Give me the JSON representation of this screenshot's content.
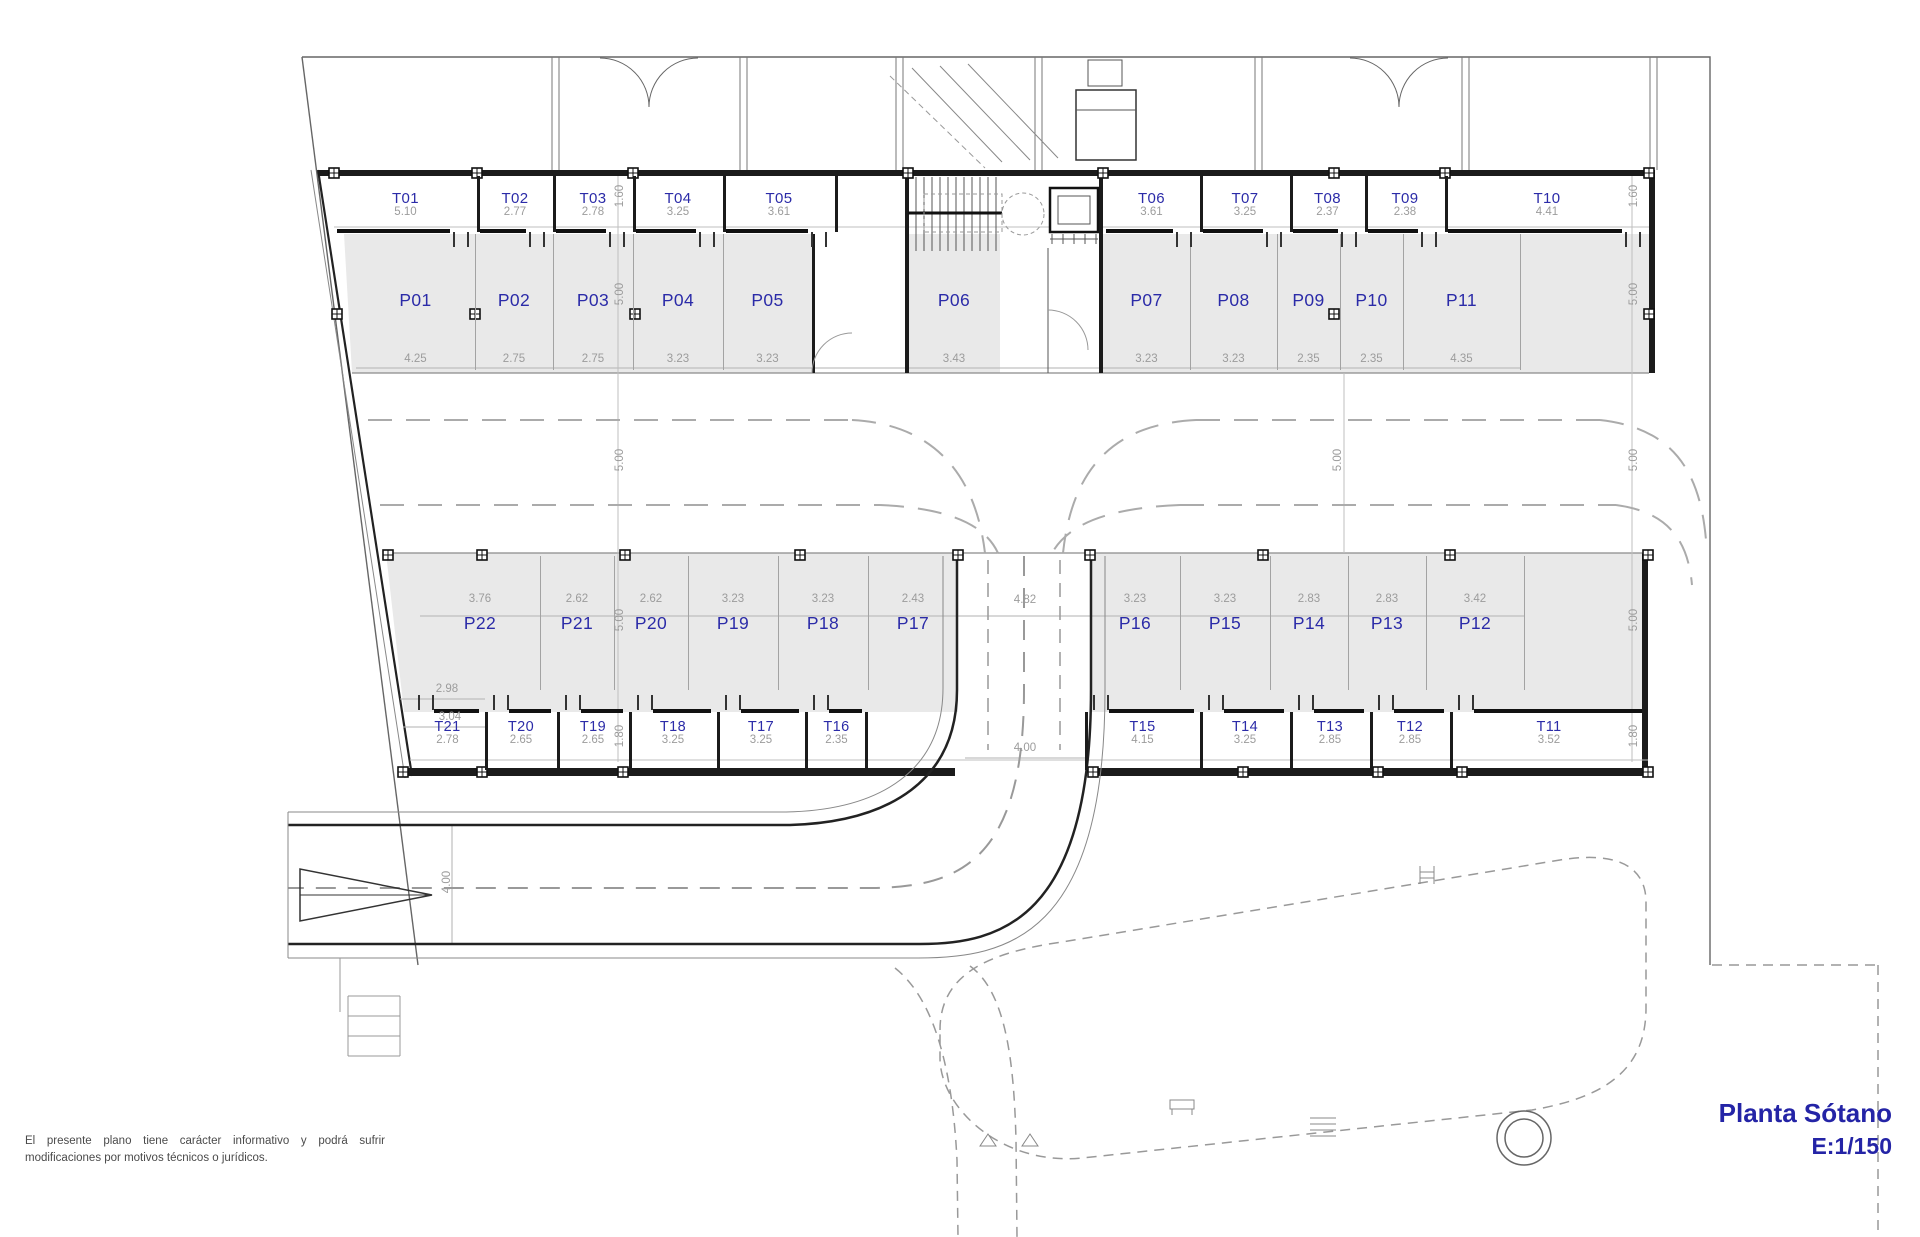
{
  "title": {
    "line1": "Planta Sótano",
    "line2": "E:1/150"
  },
  "disclaimer": {
    "line1": "El presente plano tiene carácter informativo y podrá sufrir",
    "line2": "modificaciones por motivos técnicos o jurídicos."
  },
  "colors": {
    "label_blue": "#2b2ba8",
    "dim_gray": "#9c9c9c",
    "wall_dark": "#1b1b1b",
    "stall_fill": "#e9e9e9"
  },
  "top_trasteros": [
    {
      "label": "T01",
      "dim": "5.10"
    },
    {
      "label": "T02",
      "dim": "2.77"
    },
    {
      "label": "T03",
      "dim": "2.78"
    },
    {
      "label": "T04",
      "dim": "3.25"
    },
    {
      "label": "T05",
      "dim": "3.61"
    },
    {
      "label": "T06",
      "dim": "3.61"
    },
    {
      "label": "T07",
      "dim": "3.25"
    },
    {
      "label": "T08",
      "dim": "2.37"
    },
    {
      "label": "T09",
      "dim": "2.38"
    },
    {
      "label": "T10",
      "dim": "4.41"
    }
  ],
  "top_parking": [
    {
      "label": "P01",
      "dim": "4.25"
    },
    {
      "label": "P02",
      "dim": "2.75"
    },
    {
      "label": "P03",
      "dim": "2.75"
    },
    {
      "label": "P04",
      "dim": "3.23"
    },
    {
      "label": "P05",
      "dim": "3.23"
    },
    {
      "label": "P06",
      "dim": "3.43"
    },
    {
      "label": "P07",
      "dim": "3.23"
    },
    {
      "label": "P08",
      "dim": "3.23"
    },
    {
      "label": "P09",
      "dim": "2.35"
    },
    {
      "label": "P10",
      "dim": "2.35"
    },
    {
      "label": "P11",
      "dim": "4.35"
    }
  ],
  "bottom_parking": [
    {
      "label": "P22",
      "dim": "3.76"
    },
    {
      "label": "P21",
      "dim": "2.62"
    },
    {
      "label": "P20",
      "dim": "2.62"
    },
    {
      "label": "P19",
      "dim": "3.23"
    },
    {
      "label": "P18",
      "dim": "3.23"
    },
    {
      "label": "P17",
      "dim": "2.43"
    },
    {
      "label": "P16",
      "dim": "3.23"
    },
    {
      "label": "P15",
      "dim": "3.23"
    },
    {
      "label": "P14",
      "dim": "2.83"
    },
    {
      "label": "P13",
      "dim": "2.83"
    },
    {
      "label": "P12",
      "dim": "3.42"
    }
  ],
  "bottom_trasteros": [
    {
      "label": "T21",
      "dim": "2.78"
    },
    {
      "label": "T20",
      "dim": "2.65"
    },
    {
      "label": "T19",
      "dim": "2.65"
    },
    {
      "label": "T18",
      "dim": "3.25"
    },
    {
      "label": "T17",
      "dim": "3.25"
    },
    {
      "label": "T16",
      "dim": "2.35"
    },
    {
      "label": "T15",
      "dim": "4.15"
    },
    {
      "label": "T14",
      "dim": "3.25"
    },
    {
      "label": "T13",
      "dim": "2.85"
    },
    {
      "label": "T12",
      "dim": "2.85"
    },
    {
      "label": "T11",
      "dim": "3.52"
    }
  ],
  "dims": {
    "t_top_height": "1.60",
    "stall_depth": "5.00",
    "aisle_width": "5.00",
    "t_bottom_height": "1.80",
    "ramp_width": "4.82",
    "ramp_exit_width": "4.00",
    "road_width": "4.00",
    "p22_sub_dim": "2.98",
    "p22_sub_dim2": "3.04"
  }
}
